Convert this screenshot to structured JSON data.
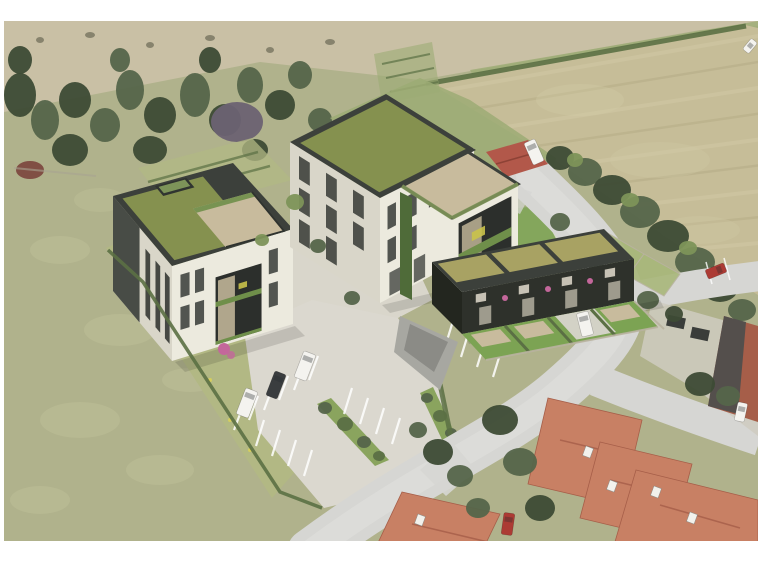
{
  "image": {
    "type": "aerial-architectural-rendering",
    "description": "Bird's-eye architectural rendering of a planned residential development: three modern green-roofed apartment buildings with white facades and dark fascias, roof terraces with stone paving and planters, a paved parking lot with marked stalls, shrub strips and parked vehicles, surrounded by green meadows, a mowed hay field bordered by tree rows, a small farm shed, and an existing neighborhood of red-tile-roof houses along a curving gray road. White border around the photo."
  },
  "colors": {
    "paper": "#ffffff",
    "meadow": "#b0b28c",
    "meadowLight": "#c2c39c",
    "scrub": "#c9c0a5",
    "scrubDark": "#6b6a55",
    "treeDark": "#3d4b35",
    "treeMid": "#55654a",
    "treeLight": "#7d9459",
    "treePurple": "#6c6272",
    "redBrush": "#7d4a40",
    "field": "#c6bd98",
    "fieldStripeLight": "#d2caa6",
    "fieldStripeDark": "#b2a983",
    "hedge": "#5b7044",
    "lawnBright": "#7ca353",
    "gardenLawn": "#b2b884",
    "grassFresh": "#9cab74",
    "roofGreen": "#85914f",
    "roofOlive": "#a8a263",
    "fascia": "#3c403b",
    "facadeDark": "#2e312b",
    "wallWhite": "#eceade",
    "wallShade": "#d9d6c9",
    "windowDark": "#2c2f2c",
    "terraceStone": "#c8bb9d",
    "paving": "#dbd8cf",
    "road": "#d6d6d3",
    "roadLight": "#e2e2df",
    "lineWhite": "#ffffff",
    "redRoof": "#c88064",
    "redRoofDark": "#a65e49",
    "shedRoof": "#b2584a",
    "grayRoof": "#4b4e4c",
    "carRed": "#ac3b34",
    "vehicleWhite": "#f4f3ef",
    "carDark": "#3a3d3f",
    "plant": "#6f8f4a",
    "plantYellow": "#c9c24a",
    "flowerPink": "#c4679b",
    "wallLow": "#b9b3a0",
    "rampGray": "#a7a7a1",
    "driveGray": "#cfcbc0"
  },
  "scene": {
    "tree_groups": [
      {
        "container": "north-tree-belt",
        "items": [
          [
            20,
            95,
            16,
            22,
            "treeDark"
          ],
          [
            45,
            120,
            14,
            20,
            "treeMid"
          ],
          [
            75,
            100,
            16,
            18,
            "treeDark"
          ],
          [
            105,
            125,
            15,
            17,
            "treeMid"
          ],
          [
            70,
            150,
            18,
            16,
            "treeDark"
          ],
          [
            130,
            90,
            14,
            20,
            "treeMid"
          ],
          [
            160,
            115,
            16,
            18,
            "treeDark"
          ],
          [
            195,
            95,
            15,
            22,
            "treeMid"
          ],
          [
            150,
            150,
            17,
            14,
            "treeDark"
          ],
          [
            225,
            120,
            16,
            16,
            "treeDark"
          ],
          [
            250,
            85,
            13,
            18,
            "treeMid"
          ],
          [
            280,
            105,
            15,
            15,
            "treeDark"
          ],
          [
            300,
            75,
            12,
            14,
            "treeMid"
          ],
          [
            20,
            60,
            12,
            14,
            "treeDark"
          ],
          [
            120,
            60,
            10,
            12,
            "treeMid"
          ],
          [
            210,
            60,
            11,
            13,
            "treeDark"
          ],
          [
            320,
            120,
            12,
            12,
            "treeMid"
          ],
          [
            255,
            150,
            13,
            11,
            "treeDark"
          ],
          [
            237,
            122,
            26,
            20,
            "treePurple"
          ],
          [
            30,
            170,
            14,
            9,
            "redBrush"
          ]
        ]
      },
      {
        "container": "east-tree-row",
        "items": [
          [
            560,
            158,
            14,
            12,
            "treeDark"
          ],
          [
            585,
            172,
            17,
            14,
            "treeMid"
          ],
          [
            612,
            190,
            19,
            15,
            "treeDark"
          ],
          [
            640,
            212,
            20,
            16,
            "treeMid"
          ],
          [
            668,
            236,
            21,
            16,
            "treeDark"
          ],
          [
            695,
            262,
            20,
            15,
            "treeMid"
          ],
          [
            720,
            288,
            18,
            14,
            "treeDark"
          ],
          [
            742,
            310,
            14,
            11,
            "treeMid"
          ],
          [
            575,
            160,
            8,
            7,
            "treeLight"
          ],
          [
            630,
            200,
            9,
            7,
            "treeLight"
          ],
          [
            688,
            248,
            9,
            7,
            "treeLight"
          ]
        ]
      },
      {
        "container": "south-trees",
        "items": [
          [
            438,
            452,
            15,
            13,
            "treeDark"
          ],
          [
            460,
            476,
            13,
            11,
            "treeMid"
          ],
          [
            500,
            420,
            18,
            15,
            "treeDark"
          ],
          [
            520,
            462,
            17,
            14,
            "treeMid"
          ],
          [
            540,
            508,
            15,
            13,
            "treeDark"
          ],
          [
            478,
            508,
            12,
            10,
            "treeMid"
          ],
          [
            700,
            384,
            15,
            12,
            "treeDark"
          ],
          [
            728,
            396,
            12,
            10,
            "treeMid"
          ],
          [
            648,
            300,
            11,
            9,
            "treeMid"
          ],
          [
            674,
            314,
            9,
            8,
            "treeDark"
          ],
          [
            560,
            222,
            10,
            9,
            "treeMid"
          ],
          [
            578,
            246,
            10,
            9,
            "treeDark"
          ],
          [
            598,
            272,
            10,
            9,
            "treeMid"
          ],
          [
            418,
            430,
            9,
            8,
            "treeMid"
          ]
        ]
      },
      {
        "container": "courtyard-trees",
        "items": [
          [
            295,
            202,
            9,
            8,
            "treeLight"
          ],
          [
            318,
            246,
            8,
            7,
            "treeMid"
          ],
          [
            262,
            240,
            7,
            6,
            "treeLight"
          ],
          [
            352,
            298,
            8,
            7,
            "treeMid"
          ]
        ]
      },
      {
        "container": "parking-shrubs",
        "items": [
          [
            325,
            408,
            7,
            6,
            "treeMid"
          ],
          [
            345,
            424,
            8,
            7,
            "hedge"
          ],
          [
            364,
            442,
            7,
            6,
            "treeMid"
          ],
          [
            379,
            456,
            6,
            5,
            "hedge"
          ],
          [
            427,
            398,
            6,
            5,
            "treeMid"
          ],
          [
            440,
            416,
            7,
            6,
            "hedge"
          ],
          [
            451,
            433,
            6,
            5,
            "treeMid"
          ]
        ]
      }
    ],
    "field_stripes": {
      "count": 9,
      "x0": 436,
      "y0": 92,
      "dx": 6,
      "dy": 22,
      "ex": 770,
      "ey0": 34,
      "edy": 26
    },
    "texture": [
      [
        40,
        40,
        4,
        3,
        "scrubDark",
        0.7
      ],
      [
        90,
        35,
        5,
        3,
        "scrubDark",
        0.7
      ],
      [
        150,
        45,
        4,
        3,
        "scrubDark",
        0.7
      ],
      [
        210,
        38,
        5,
        3,
        "scrubDark",
        0.7
      ],
      [
        270,
        50,
        4,
        3,
        "scrubDark",
        0.7
      ],
      [
        330,
        42,
        5,
        3,
        "scrubDark",
        0.7
      ],
      [
        60,
        250,
        30,
        14,
        "meadowLight",
        0.4
      ],
      [
        120,
        330,
        36,
        16,
        "meadowLight",
        0.4
      ],
      [
        80,
        420,
        40,
        18,
        "meadowLight",
        0.4
      ],
      [
        160,
        470,
        34,
        15,
        "meadowLight",
        0.4
      ],
      [
        40,
        500,
        30,
        14,
        "meadowLight",
        0.4
      ],
      [
        190,
        380,
        28,
        12,
        "meadowLight",
        0.4
      ],
      [
        100,
        200,
        26,
        12,
        "meadowLight",
        0.35
      ],
      [
        580,
        100,
        44,
        16,
        "fieldStripeLight",
        0.35
      ],
      [
        660,
        160,
        50,
        18,
        "fieldStripeLight",
        0.3
      ],
      [
        700,
        230,
        40,
        14,
        "fieldStripeLight",
        0.3
      ]
    ],
    "stall_rows": [
      {
        "x": 234,
        "y": 430,
        "n": 6,
        "sx": 15,
        "sy": -10,
        "lx": 9,
        "ly": -24
      },
      {
        "x": 256,
        "y": 446,
        "n": 4,
        "sx": 16,
        "sy": 10,
        "lx": 8,
        "ly": -26
      },
      {
        "x": 344,
        "y": 414,
        "n": 4,
        "sx": 16,
        "sy": 10,
        "lx": 8,
        "ly": -26
      },
      {
        "x": 445,
        "y": 347,
        "n": 4,
        "sx": 16,
        "sy": 10,
        "lx": 8,
        "ly": -26
      }
    ],
    "houses": [
      {
        "name": "house-roof-main",
        "pts": "548,398 642,420 622,506 528,484",
        "c": "redRoof",
        "ridge": [
          560,
          440,
          636,
          458
        ]
      },
      {
        "name": "house-roof-wing",
        "pts": "600,442 692,464 672,540 580,518",
        "c": "redRoof",
        "ridge": [
          610,
          480,
          668,
          494
        ]
      },
      {
        "name": "house-roof-southwest",
        "pts": "402,492 500,514 476,564 368,564",
        "c": "redRoof",
        "ridge": [
          412,
          524,
          488,
          542
        ]
      },
      {
        "name": "house-roof-corner",
        "pts": "636,470 758,500 758,564 612,552",
        "c": "redRoof",
        "ridge": [
          660,
          505,
          740,
          528
        ]
      }
    ],
    "skylights": [
      [
        588,
        452
      ],
      [
        612,
        486
      ],
      [
        656,
        492
      ],
      [
        692,
        518
      ],
      [
        420,
        520
      ]
    ],
    "garages": [
      [
        676,
        322
      ],
      [
        700,
        334
      ],
      [
        744,
        402
      ]
    ],
    "vehicles": [
      {
        "name": "white-van-1",
        "x": 247,
        "y": 403,
        "w": 13,
        "h": 28,
        "rot": 21,
        "c": "vehicleWhite"
      },
      {
        "name": "dark-car",
        "x": 276,
        "y": 385,
        "w": 12,
        "h": 26,
        "rot": 21,
        "c": "carDark"
      },
      {
        "name": "white-van-2",
        "x": 305,
        "y": 366,
        "w": 13,
        "h": 28,
        "rot": 21,
        "c": "vehicleWhite"
      },
      {
        "name": "white-car-rowhouse-drive",
        "x": 585,
        "y": 324,
        "w": 12,
        "h": 24,
        "rot": -14,
        "c": "vehicleWhite"
      },
      {
        "name": "red-car-roadside",
        "x": 716,
        "y": 271,
        "w": 10,
        "h": 20,
        "rot": 68,
        "c": "carRed"
      },
      {
        "name": "red-car-driveway",
        "x": 508,
        "y": 524,
        "w": 11,
        "h": 22,
        "rot": 8,
        "c": "carRed"
      },
      {
        "name": "white-car-corner-field",
        "x": 750,
        "y": 46,
        "w": 8,
        "h": 14,
        "rot": 40,
        "c": "vehicleWhite"
      },
      {
        "name": "white-car-garage-court",
        "x": 741,
        "y": 412,
        "w": 10,
        "h": 19,
        "rot": 12,
        "c": "vehicleWhite"
      },
      {
        "name": "white-trailer-shed",
        "x": 534,
        "y": 152,
        "w": 12,
        "h": 24,
        "rot": -24,
        "c": "vehicleWhite"
      }
    ],
    "garden_flowers": [
      [
        160,
        300
      ],
      [
        190,
        340
      ],
      [
        150,
        270
      ],
      [
        210,
        380
      ],
      [
        230,
        420
      ],
      [
        250,
        450
      ]
    ],
    "facade_flowers": [
      [
        505,
        298
      ],
      [
        548,
        289
      ],
      [
        590,
        281
      ]
    ]
  }
}
